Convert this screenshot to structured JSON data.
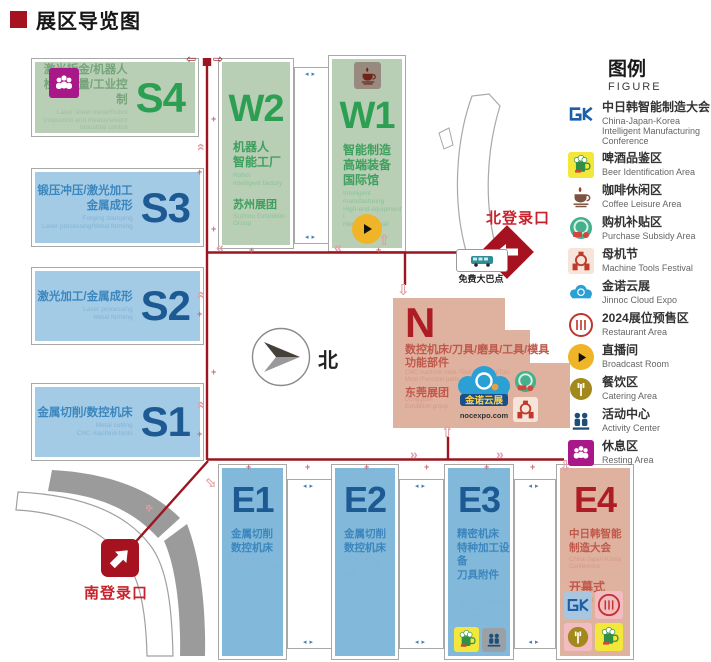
{
  "page": {
    "title": "展区导览图"
  },
  "compass": {
    "north_label": "北"
  },
  "markers": {
    "north_entrance": "北登录口",
    "south_entrance": "南登录口",
    "free_bus_point": "免费大巴点"
  },
  "halls": {
    "s4": {
      "code": "S4",
      "zh": "激光钣金/机器人\n检测测量/工业控制",
      "en": "Laser sheet metal/Robot\nInspection and measurement\nIndustrial control"
    },
    "s3": {
      "code": "S3",
      "zh": "锻压冲压/激光加工\n金属成形",
      "en": "Forging stamping\nLaser processing/Metal forming"
    },
    "s2": {
      "code": "S2",
      "zh": "激光加工/金属成形",
      "en": "Laser processing\nMetal forming"
    },
    "s1": {
      "code": "S1",
      "zh": "金属切削/数控机床",
      "en": "Metal cutting\nCNC machine tools"
    },
    "w2": {
      "code": "W2",
      "zh": "机器人\n智能工厂",
      "en": "Robot\nIntelligent factory",
      "group_zh": "苏州展团",
      "group_en": "Suzhou Exhibition Group"
    },
    "w1": {
      "code": "W1",
      "zh": "智能制造\n高端装备\n国际馆",
      "en": "Intelligent manufacturing\nHigh-end equipment I\nnternational hall"
    },
    "n": {
      "code": "N",
      "zh": "数控机床/刀具/磨具/工具/模具\n功能部件",
      "en": "CNC machine tools /Tool /Grinding/Tool\nMold /Function parts",
      "group_zh": "东莞展团",
      "group_en": "Dongguan\nExhibition group"
    },
    "e1": {
      "code": "E1",
      "zh": "金属切削\n数控机床",
      "en": "Metal cutting\nCNC machine tools"
    },
    "e2": {
      "code": "E2",
      "zh": "金属切削\n数控机床",
      "en": "Metal cutting\nCNC machine tools"
    },
    "e3": {
      "code": "E3",
      "zh": "精密机床\n特种加工设备\n刀具附件",
      "en": "Precision machine tools\nSpecial processing equipment\nMachine tool accessories"
    },
    "e4": {
      "code": "E4",
      "zh": "中日韩智能\n制造大会",
      "en": "China-Japan-Korea\nConference",
      "extra_zh": "开幕式",
      "extra_en": "Opening ceremony"
    }
  },
  "cloud_logo": {
    "name": "金诺云展",
    "site": "nocexpo.com"
  },
  "legend": {
    "title": "图例",
    "subtitle": "FIGURE",
    "items": [
      {
        "icon": "gk-logo-icon",
        "zh": "中日韩智能制造大会",
        "en": "China-Japan-Korea Intelligent Manufacturing Conference"
      },
      {
        "icon": "beer-icon",
        "zh": "啤酒品鉴区",
        "en": "Beer Identification Area"
      },
      {
        "icon": "coffee-icon",
        "zh": "咖啡休闲区",
        "en": "Coffee Leisure Area"
      },
      {
        "icon": "subsidy-icon",
        "zh": "购机补贴区",
        "en": "Purchase Subsidy Area"
      },
      {
        "icon": "festival-icon",
        "zh": "母机节",
        "en": "Machine Tools Festival"
      },
      {
        "icon": "cloud-icon",
        "zh": "金诺云展",
        "en": "Jinnoc Cloud Expo"
      },
      {
        "icon": "presale-icon",
        "zh": "2024展位预售区",
        "en": "Restaurant Area"
      },
      {
        "icon": "broadcast-icon",
        "zh": "直播间",
        "en": "Broadcast Room"
      },
      {
        "icon": "catering-icon",
        "zh": "餐饮区",
        "en": "Catering  Area"
      },
      {
        "icon": "activity-icon",
        "zh": "活动中心",
        "en": "Activity Center"
      },
      {
        "icon": "resting-icon",
        "zh": "休息区",
        "en": "Resting Area"
      }
    ]
  },
  "colors": {
    "road_red": "#9c1520",
    "entrance_red": "#a6121f",
    "entrance_label_red": "#c8232d",
    "light_arrow_pink": "#df9fa6",
    "hall_blue_s": "#a3cbe5",
    "hall_blue_e": "#82b9da",
    "hall_green": "#b8cfb5",
    "hall_salmon": "#dfb2a0",
    "code_blue": "#1d5a94",
    "code_green": "#2d9f53",
    "code_red": "#ad1d24",
    "text_blue": "#3c86be",
    "text_red": "#c0584b",
    "outline_gray": "#a8a8a8",
    "title_red": "#a6121f"
  }
}
